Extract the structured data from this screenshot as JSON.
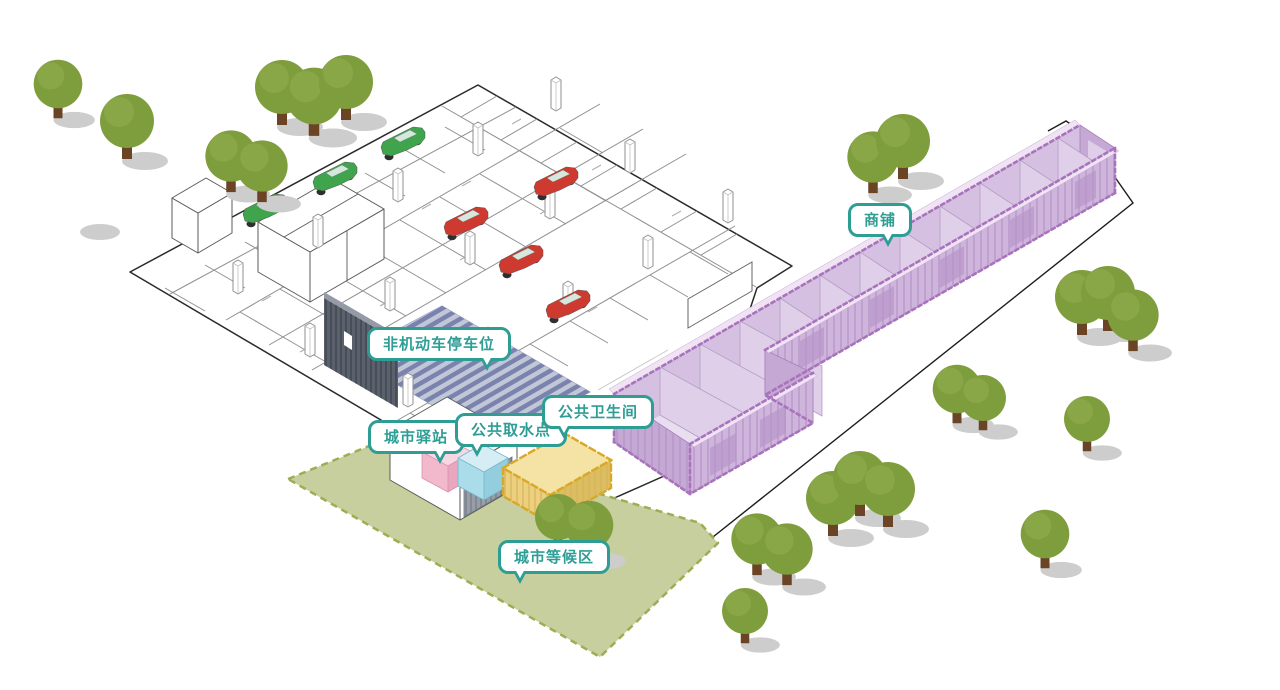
{
  "labels": {
    "shops": "商铺",
    "bike_parking": "非机动车停车位",
    "city_station": "城市驿站",
    "water_point": "公共取水点",
    "public_toilet": "公共卫生间",
    "waiting_area": "城市等候区"
  },
  "colors": {
    "teal": "#2e9e95",
    "shop-purple": "#cfb5dc",
    "shop-purple-light": "#e9def0",
    "shop-outline": "#a873bc",
    "station-pink": "#f2b9cc",
    "water-blue": "#abdcea",
    "toilet-yellow": "#eccf7f",
    "toilet-outline": "#d8a826",
    "lawn": "#c6cf9d",
    "lawn-border": "#9fad52",
    "tree": "#7e9d3d",
    "trunk": "#6a4425",
    "shadow": "#cdcdcd",
    "car-red": "#ce3a2f",
    "car-green": "#3fa44c",
    "shed": "#5a616c",
    "hatch": "#7a83ad"
  }
}
